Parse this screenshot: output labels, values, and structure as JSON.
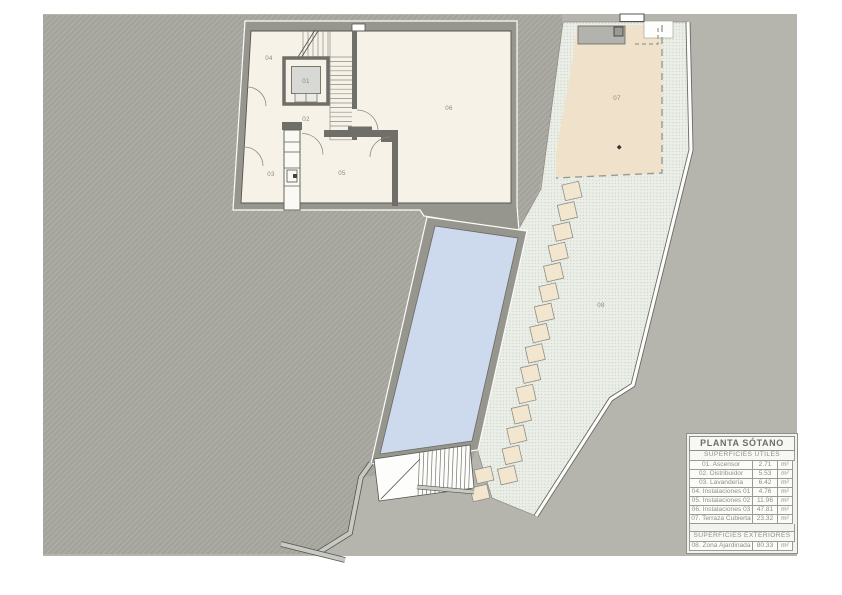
{
  "plan": {
    "room_labels": {
      "r01": "01",
      "r02": "02",
      "r03": "03",
      "r04": "04",
      "r05": "05",
      "r06": "06",
      "r07": "07",
      "r08": "08"
    }
  },
  "legend": {
    "title": "PLANTA SÓTANO",
    "sections": [
      {
        "header": "SUPERFICIES ÚTILES",
        "rows": [
          {
            "name": "01. Ascensor",
            "value": "2.71",
            "unit": "m²"
          },
          {
            "name": "02. Distribuidor",
            "value": "5.53",
            "unit": "m²"
          },
          {
            "name": "03. Lavandería",
            "value": "6.42",
            "unit": "m²"
          },
          {
            "name": "04. Instalaciones 01",
            "value": "4.76",
            "unit": "m²"
          },
          {
            "name": "05. Instalaciones 02",
            "value": "11.96",
            "unit": "m²"
          },
          {
            "name": "06. Instalaciones 03",
            "value": "47.81",
            "unit": "m²"
          },
          {
            "name": "07. Terraza Cubierta",
            "value": "23.32",
            "unit": "m²"
          }
        ]
      },
      {
        "header": "SUPERFICIES EXTERIORES",
        "rows": [
          {
            "name": "08. Zona Ajardinada",
            "value": "80.33",
            "unit": "m²"
          }
        ]
      }
    ]
  },
  "colors": {
    "backdrop": "#b6b5ad",
    "terrain_hatch": "#a5a49c",
    "building_wall": "#97968e",
    "interior": "#f7f2e8",
    "pool_water": "#cdd9ed",
    "terrace": "#f0e2ca",
    "stepping_stone": "#f3e6cf",
    "garden": "#eaeee7",
    "line": "#55544f",
    "label_text": "#8b8a82"
  }
}
